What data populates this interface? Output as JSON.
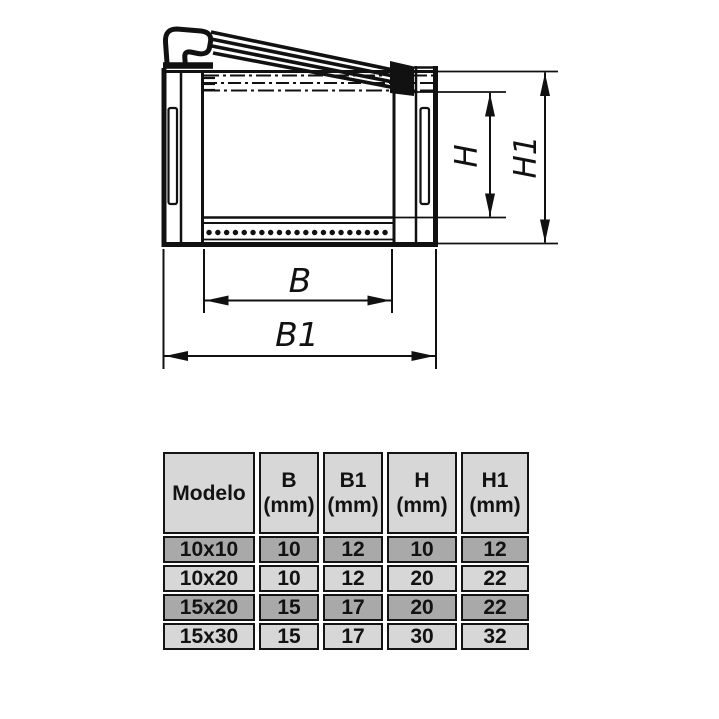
{
  "diagram": {
    "dim_labels": {
      "b": "B",
      "b1": "B1",
      "h": "H",
      "h1": "H1"
    },
    "line_color": "#111111"
  },
  "table": {
    "columns": [
      {
        "label": "Modelo",
        "unit": ""
      },
      {
        "label": "B",
        "unit": "(mm)"
      },
      {
        "label": "B1",
        "unit": "(mm)"
      },
      {
        "label": "H",
        "unit": "(mm)"
      },
      {
        "label": "H1",
        "unit": "(mm)"
      }
    ],
    "rows": [
      {
        "modelo": "10x10",
        "b": "10",
        "b1": "12",
        "h": "10",
        "h1": "12"
      },
      {
        "modelo": "10x20",
        "b": "10",
        "b1": "12",
        "h": "20",
        "h1": "22"
      },
      {
        "modelo": "15x20",
        "b": "15",
        "b1": "17",
        "h": "20",
        "h1": "22"
      },
      {
        "modelo": "15x30",
        "b": "15",
        "b1": "17",
        "h": "30",
        "h1": "32"
      }
    ],
    "colors": {
      "header_bg": "#d7d7d7",
      "row_dark_bg": "#a9a9a9",
      "row_light_bg": "#d7d7d7",
      "border": "#141414"
    }
  }
}
